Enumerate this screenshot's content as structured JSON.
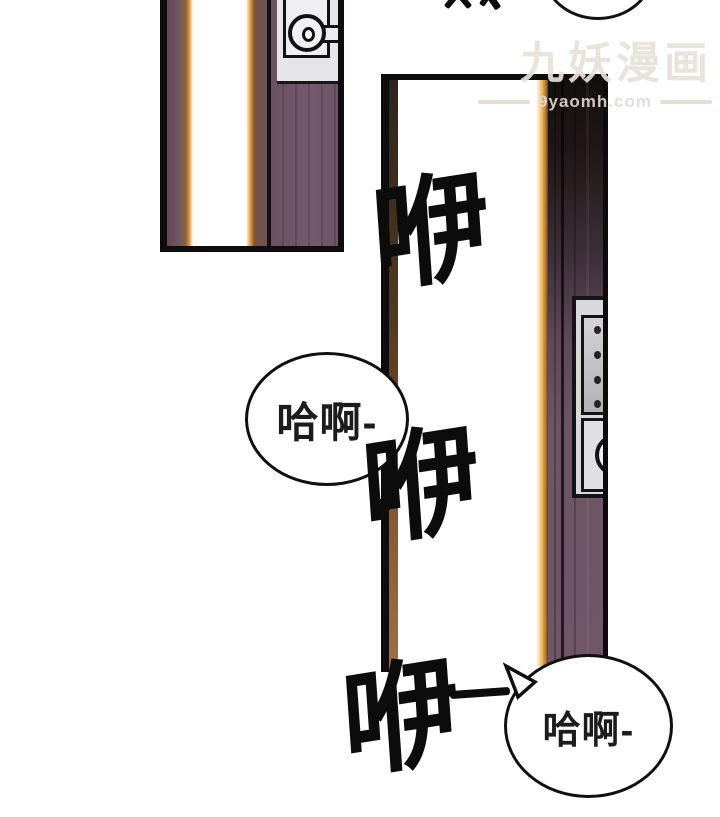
{
  "watermark": {
    "title": "九妖漫画",
    "site": "9yaomh.com"
  },
  "sound_effects": {
    "sfx1": "咿",
    "sfx2": "咿",
    "sfx3": "咿"
  },
  "speech": {
    "bubble_left": "哈啊-",
    "bubble_right": "哈啊-"
  },
  "colors": {
    "background": "#ffffff",
    "outline_black": "#0e0c0d",
    "door_purple": "#6d5565",
    "door_dark_top": "#1f1715",
    "light_glow_orange": "#d89a44",
    "lock_plate_gray": "#d9d9db",
    "watermark_gray": "#e7e1d8"
  }
}
